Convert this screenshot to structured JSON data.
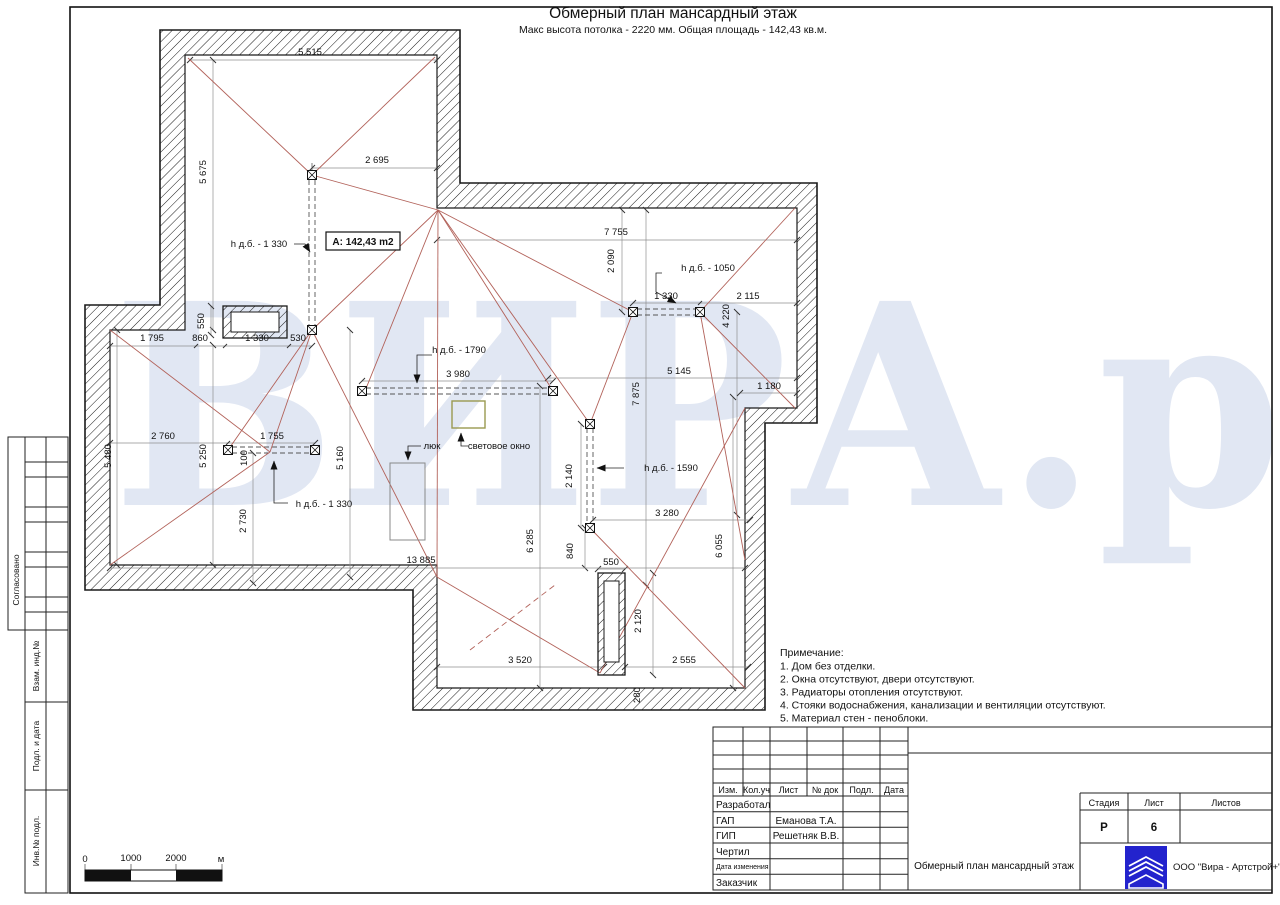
{
  "page": {
    "title": "Обмерный план мансардный этаж",
    "subtitle": "Макс высота потолка - 2220 мм. Общая площадь - 142,43 кв.м."
  },
  "watermark": {
    "text": "ВИРА.рф",
    "color": "#e1e7f3"
  },
  "colors": {
    "roof_line": "#b2625a",
    "wall_outline": "#1a1a1a",
    "dim_line": "#8f8f8f",
    "skylight_border": "#9a9a50",
    "logo_blue": "#2323cd"
  },
  "plan": {
    "area_label": "A: 142,43 m2",
    "labels": [
      {
        "t": "5 515",
        "x": 310,
        "y": 55
      },
      {
        "t": "5 675",
        "x": 206,
        "y": 172,
        "r": 1
      },
      {
        "t": "2 695",
        "x": 377,
        "y": 163
      },
      {
        "t": "h д.б. - 1 330",
        "x": 259,
        "y": 247,
        "n": "height-callout"
      },
      {
        "t": "A: 142,43 m2",
        "x": 363,
        "y": 245,
        "c": "area",
        "n": "area-label"
      },
      {
        "t": "7 755",
        "x": 616,
        "y": 235
      },
      {
        "t": "2 090",
        "x": 614,
        "y": 261,
        "r": 1
      },
      {
        "t": "h д.б. - 1050",
        "x": 708,
        "y": 271,
        "n": "height-callout"
      },
      {
        "t": "1 330",
        "x": 666,
        "y": 299
      },
      {
        "t": "2 115",
        "x": 748,
        "y": 299
      },
      {
        "t": "4 220",
        "x": 729,
        "y": 316,
        "r": 1
      },
      {
        "t": "550",
        "x": 204,
        "y": 321,
        "r": 1
      },
      {
        "t": "1 795",
        "x": 152,
        "y": 341
      },
      {
        "t": "860",
        "x": 200,
        "y": 341
      },
      {
        "t": "1 330",
        "x": 257,
        "y": 341
      },
      {
        "t": "530",
        "x": 298,
        "y": 341
      },
      {
        "t": "h д.б. - 1790",
        "x": 459,
        "y": 353,
        "n": "height-callout"
      },
      {
        "t": "3 980",
        "x": 458,
        "y": 377
      },
      {
        "t": "5 145",
        "x": 679,
        "y": 374
      },
      {
        "t": "7 875",
        "x": 639,
        "y": 394,
        "r": 1
      },
      {
        "t": "1 180",
        "x": 769,
        "y": 389
      },
      {
        "t": "2 760",
        "x": 163,
        "y": 439
      },
      {
        "t": "1 755",
        "x": 272,
        "y": 439
      },
      {
        "t": "5 480",
        "x": 111,
        "y": 456,
        "r": 1
      },
      {
        "t": "5 250",
        "x": 206,
        "y": 456,
        "r": 1
      },
      {
        "t": "100",
        "x": 247,
        "y": 458,
        "r": 1
      },
      {
        "t": "5 160",
        "x": 343,
        "y": 458,
        "r": 1
      },
      {
        "t": "люк",
        "x": 432,
        "y": 449,
        "n": "hatch-callout"
      },
      {
        "t": "световое окно",
        "x": 499,
        "y": 449,
        "n": "skylight-callout"
      },
      {
        "t": "h д.б. - 1590",
        "x": 671,
        "y": 471,
        "n": "height-callout"
      },
      {
        "t": "2 140",
        "x": 572,
        "y": 476,
        "r": 1
      },
      {
        "t": "h д.б. - 1 330",
        "x": 324,
        "y": 507,
        "n": "height-callout"
      },
      {
        "t": "3 280",
        "x": 667,
        "y": 516
      },
      {
        "t": "2 730",
        "x": 246,
        "y": 521,
        "r": 1
      },
      {
        "t": "6 285",
        "x": 533,
        "y": 541,
        "r": 1
      },
      {
        "t": "840",
        "x": 573,
        "y": 551,
        "r": 1
      },
      {
        "t": "6 055",
        "x": 722,
        "y": 546,
        "r": 1
      },
      {
        "t": "550",
        "x": 611,
        "y": 565
      },
      {
        "t": "13 885",
        "x": 421,
        "y": 563
      },
      {
        "t": "2 120",
        "x": 641,
        "y": 621,
        "r": 1
      },
      {
        "t": "3 520",
        "x": 520,
        "y": 663
      },
      {
        "t": "2 555",
        "x": 684,
        "y": 663
      },
      {
        "t": "280",
        "x": 640,
        "y": 695,
        "r": 1
      }
    ]
  },
  "notes": {
    "title": "Примечание:",
    "items": [
      "1. Дом без отделки.",
      "2. Окна отсутствуют, двери отсутствуют.",
      "3. Радиаторы отопления отсутствуют.",
      "4. Стояки водоснабжения, канализации и вентиляции отсутствуют.",
      "5. Материал стен - пеноблоки."
    ]
  },
  "scale_bar": {
    "ticks": [
      "0",
      "1000",
      "2000"
    ],
    "unit": "м"
  },
  "sidebar": {
    "stamps": [
      "Согласовано",
      "Взам. инд.№",
      "Подл. и дата",
      "Инв.№ подл."
    ]
  },
  "title_block": {
    "revision_header": [
      "Изм.",
      "Кол.уч",
      "Лист",
      "№ док",
      "Подл.",
      "Дата"
    ],
    "signature_rows": [
      {
        "label": "Разработал",
        "value": ""
      },
      {
        "label": "ГАП",
        "value": "Еманова Т.А."
      },
      {
        "label": "ГИП",
        "value": "Решетняк В.В."
      },
      {
        "label": "Чертил",
        "value": ""
      },
      {
        "label": "Дата изменения",
        "value": ""
      },
      {
        "label": "Заказчик",
        "value": ""
      }
    ],
    "stage_cols": [
      {
        "label": "Стадия",
        "value": "Р"
      },
      {
        "label": "Лист",
        "value": "6"
      },
      {
        "label": "Листов",
        "value": ""
      }
    ],
    "doc_title": "Обмерный план мансардный этаж",
    "company": "ООО \"Вира - Артстрой+\""
  }
}
